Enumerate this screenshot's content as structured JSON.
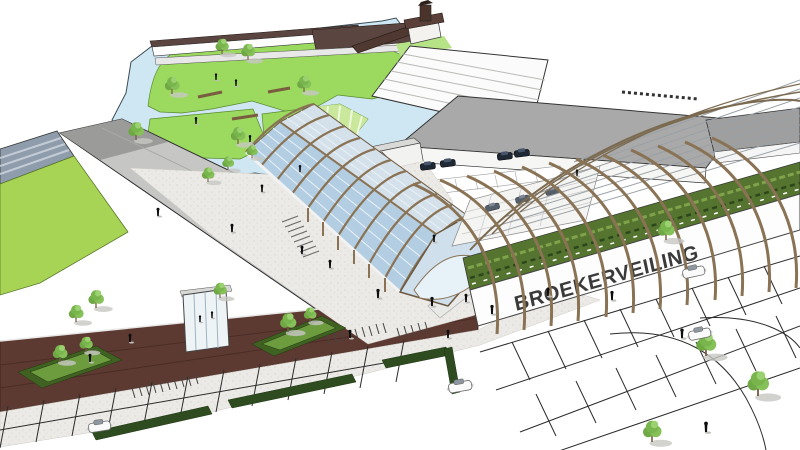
{
  "signage": {
    "fascia_label": "BROEKERVEILING"
  },
  "scene": {
    "style": "sketchup-3d-massing-render",
    "features": [
      "museum-tower",
      "auction-sheds",
      "canal-park-pond",
      "grass-islands",
      "foot-bridges",
      "warehouse-building",
      "timber-gridshell-hall",
      "timber-rib-canopy-hall",
      "green-plant-facade",
      "rooftop-parking-deck",
      "fascia-sign-band",
      "brick-building",
      "sports-field",
      "grandstand",
      "glass-entrance",
      "pedestrian-plaza",
      "hedges",
      "bike-racks",
      "green-traffic-islands",
      "parking-lot",
      "parked-cars",
      "pedestrians",
      "trees"
    ]
  },
  "palette": {
    "sky": "#ffffff",
    "water": "#cfe7f3",
    "grass": "#9bd95f",
    "grass_striped": "#c9e89b",
    "sports_field": "#a8d455",
    "timber": "#8a7355",
    "timber_dark": "#6e5a42",
    "glass_near": "#b3cee2",
    "glass_far": "#d4e1ea",
    "glass_pale": "#e7f1f8",
    "brick": "#5d3a31",
    "brick_dark": "#4c2e27",
    "roof_gray": "#c6c6c4",
    "flat_roof_gray": "#a9a9a9",
    "shed_roof": "#5b4540",
    "plant_facade": "#55742f",
    "hedge": "#2f4c20",
    "island_dark": "#3f6223",
    "island_light": "#6d9c3f",
    "pavement": "#eceae6",
    "stand_blue_gray": "#8f9cac",
    "sign_text": "#3a3a3a",
    "line_dark": "#333333"
  }
}
